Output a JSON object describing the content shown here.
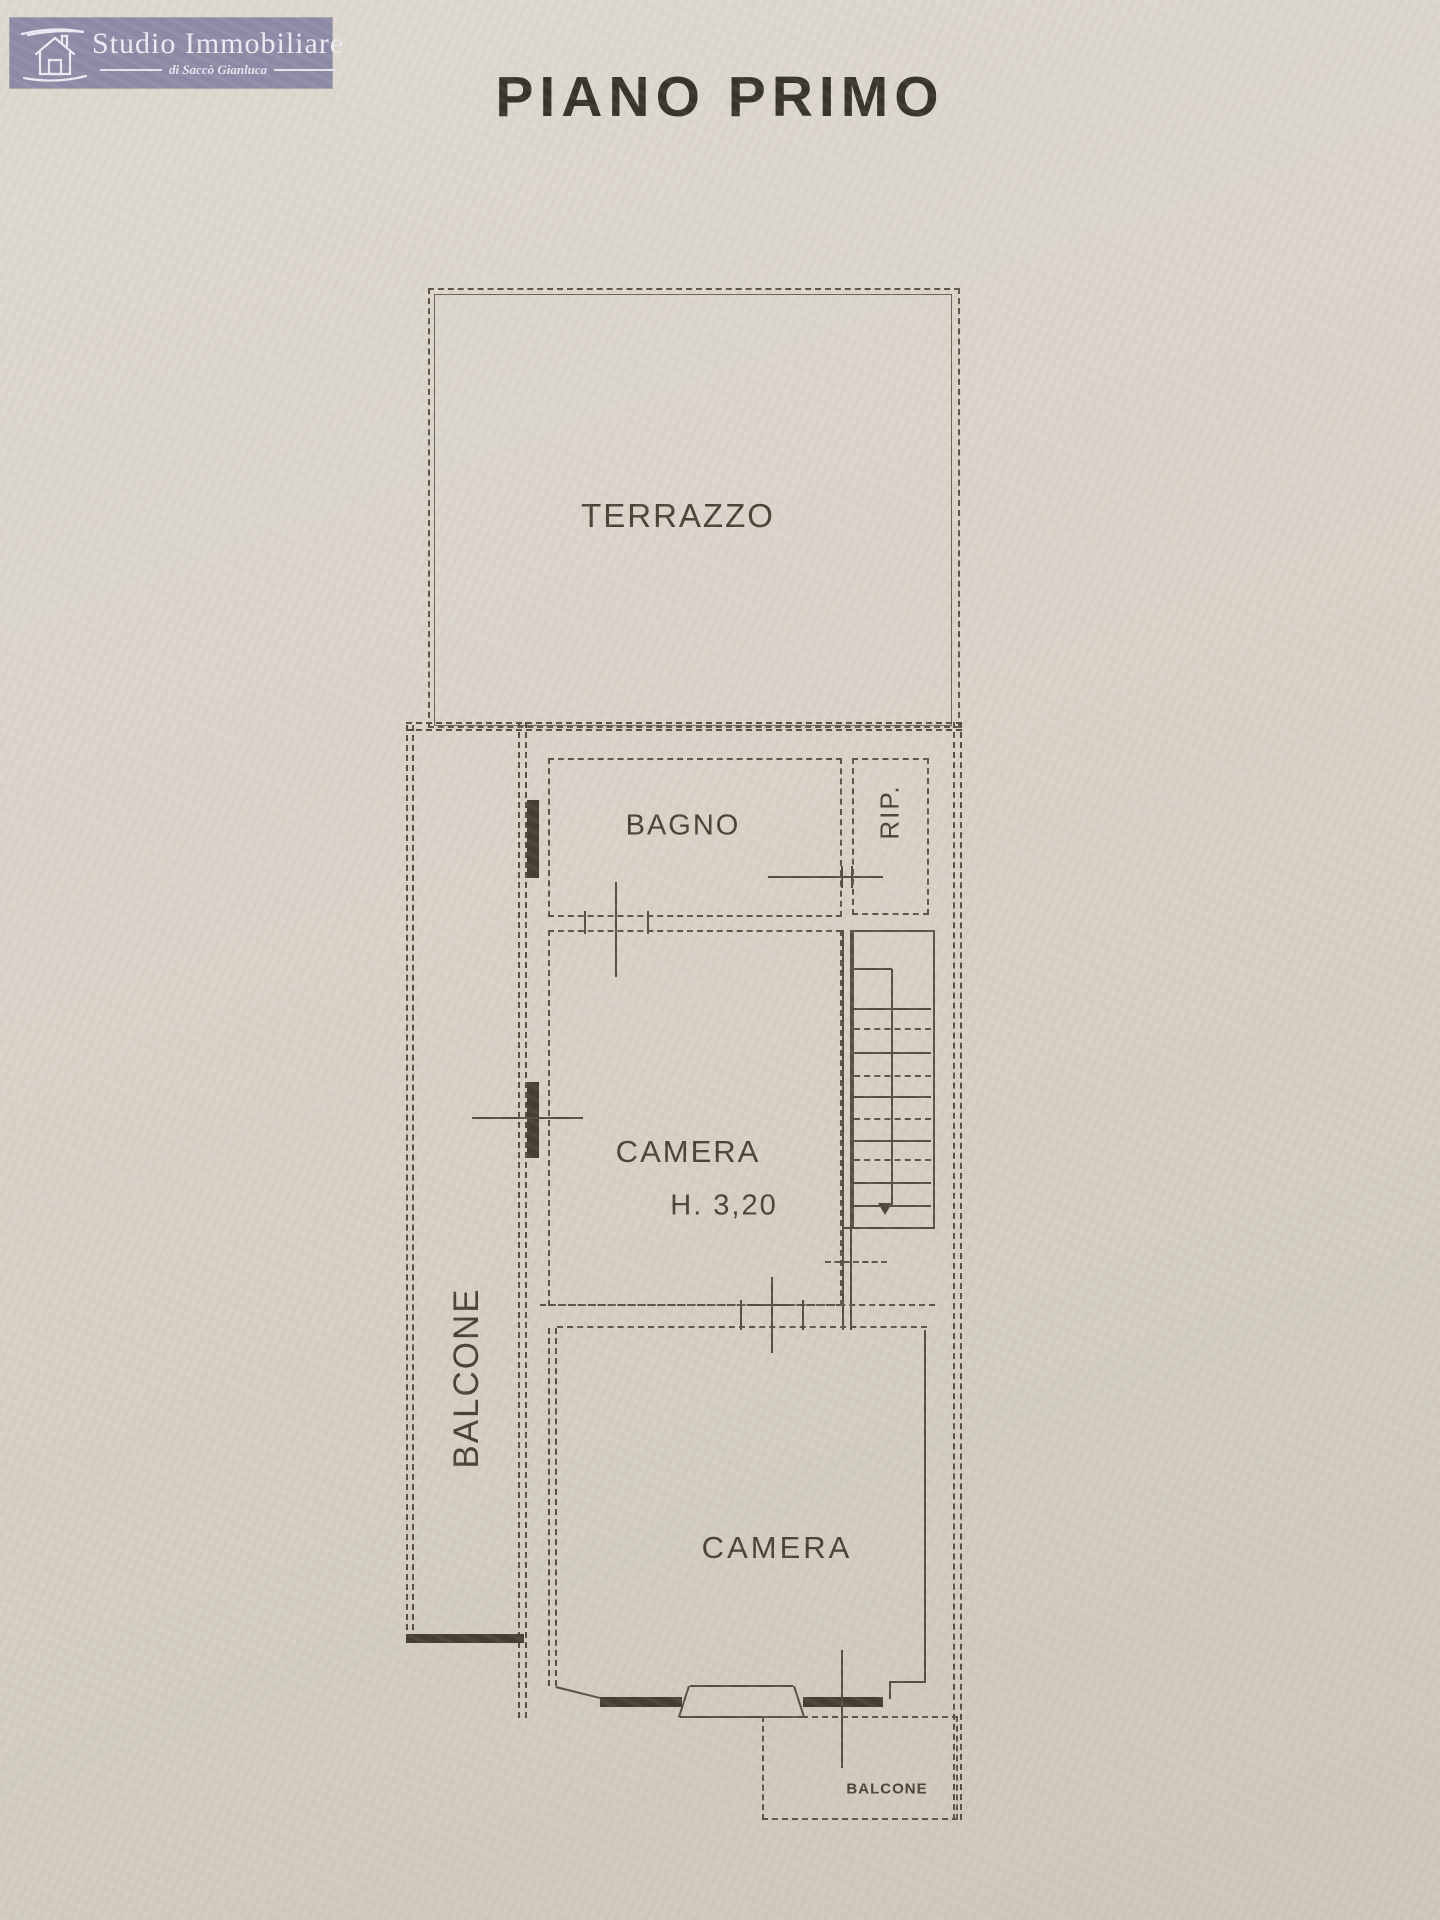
{
  "page": {
    "title": "PIANO PRIMO"
  },
  "logo": {
    "name": "Studio Immobiliare",
    "subtitle": "di Saccò Gianluca",
    "icon": "house-icon",
    "bg_color": "#8d8aa6",
    "text_color": "#edeaf3"
  },
  "colors": {
    "paper": "#d8d2c7",
    "ink": "#564d40",
    "label_text": "#4a4136"
  },
  "rooms": {
    "terrazzo": {
      "label": "TERRAZZO"
    },
    "bagno": {
      "label": "BAGNO"
    },
    "rip": {
      "label": "RIP."
    },
    "camera_upper": {
      "label": "CAMERA",
      "height_note": "H. 3,20"
    },
    "balcone_left": {
      "label": "BALCONE"
    },
    "camera_lower": {
      "label": "CAMERA"
    },
    "balcone_lower": {
      "label": "BALCONE"
    }
  }
}
